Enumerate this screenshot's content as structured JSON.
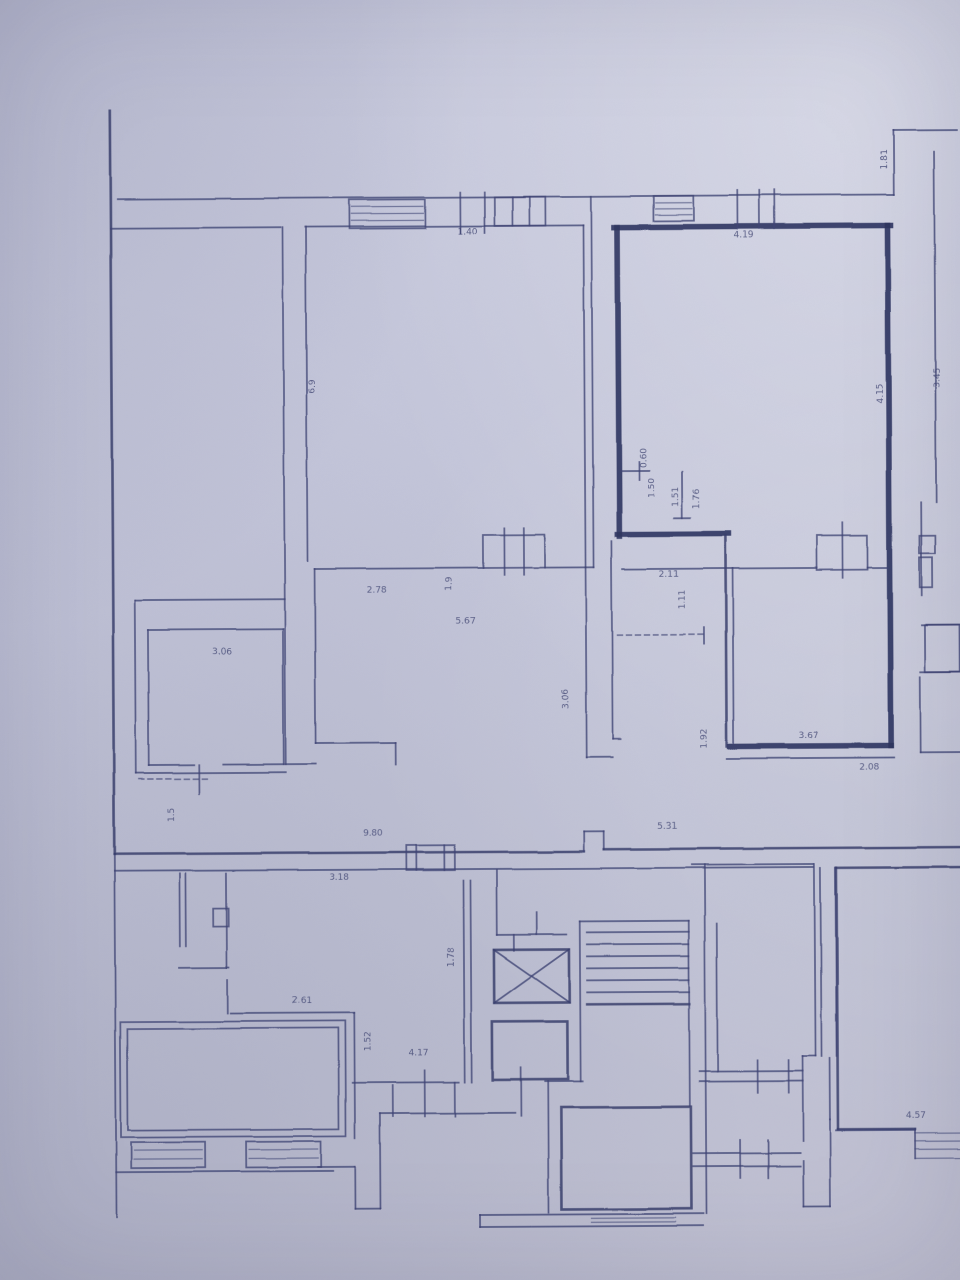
{
  "document": {
    "kind": "scanned architectural floor plan photo",
    "paper_color": "#c4c6da",
    "ink_color": "#3e4374",
    "thick_wall_color": "#2f355f"
  },
  "plan": {
    "walls": [
      [
        113,
        108,
        113,
        852,
        "m"
      ],
      [
        113,
        852,
        113,
        1215,
        "t"
      ],
      [
        120,
        197,
        897,
        197,
        "t"
      ],
      [
        897,
        133,
        897,
        197,
        "t"
      ],
      [
        897,
        133,
        960,
        133,
        "t"
      ],
      [
        937,
        155,
        937,
        505,
        "t"
      ],
      [
        922,
        505,
        922,
        598,
        "t"
      ],
      [
        113,
        226,
        283,
        226,
        "t"
      ],
      [
        285,
        226,
        285,
        763,
        "t"
      ],
      [
        308,
        226,
        308,
        560,
        "t"
      ],
      [
        308,
        226,
        586,
        226,
        "t"
      ],
      [
        594,
        197,
        594,
        568,
        "t"
      ],
      [
        586,
        226,
        586,
        568,
        "t"
      ],
      [
        586,
        568,
        586,
        758,
        "t"
      ],
      [
        612,
        542,
        612,
        740,
        "t"
      ],
      [
        586,
        758,
        612,
        758,
        "t"
      ],
      [
        612,
        740,
        620,
        740,
        "t"
      ],
      [
        315,
        568,
        484,
        568,
        "t"
      ],
      [
        545,
        568,
        594,
        568,
        "t"
      ],
      [
        315,
        568,
        315,
        742,
        "t"
      ],
      [
        315,
        742,
        395,
        742,
        "t"
      ],
      [
        395,
        742,
        395,
        764,
        "t"
      ],
      [
        135,
        598,
        285,
        598,
        "t"
      ],
      [
        135,
        598,
        135,
        771,
        "t"
      ],
      [
        135,
        771,
        285,
        771,
        "t"
      ],
      [
        148,
        628,
        283,
        628,
        "t"
      ],
      [
        148,
        628,
        148,
        763,
        "t"
      ],
      [
        283,
        628,
        283,
        763,
        "t"
      ],
      [
        148,
        763,
        193,
        763,
        "t"
      ],
      [
        222,
        763,
        283,
        763,
        "t"
      ],
      [
        198,
        763,
        198,
        792,
        "t"
      ],
      [
        285,
        763,
        315,
        763,
        "t"
      ],
      [
        617,
        228,
        893,
        228,
        "k"
      ],
      [
        620,
        228,
        620,
        537,
        "k"
      ],
      [
        890,
        228,
        890,
        748,
        "k"
      ],
      [
        729,
        748,
        890,
        748,
        "k"
      ],
      [
        618,
        535,
        729,
        535,
        "k"
      ],
      [
        726,
        537,
        726,
        748,
        "m"
      ],
      [
        733,
        570,
        733,
        745,
        "t"
      ],
      [
        623,
        570,
        817,
        570,
        "t"
      ],
      [
        868,
        570,
        888,
        570,
        "t"
      ],
      [
        726,
        760,
        893,
        760,
        "t"
      ],
      [
        617,
        636,
        704,
        636,
        "d"
      ],
      [
        704,
        629,
        704,
        645,
        "t"
      ],
      [
        622,
        472,
        650,
        472,
        "t"
      ],
      [
        640,
        463,
        640,
        481,
        "t"
      ],
      [
        683,
        473,
        683,
        519,
        "t"
      ],
      [
        675,
        519,
        691,
        519,
        "t"
      ],
      [
        113,
        852,
        583,
        852,
        "m"
      ],
      [
        583,
        832,
        583,
        852,
        "t"
      ],
      [
        583,
        832,
        603,
        832,
        "t"
      ],
      [
        603,
        832,
        603,
        850,
        "t"
      ],
      [
        603,
        850,
        960,
        850,
        "m"
      ],
      [
        113,
        869,
        812,
        869,
        "t"
      ],
      [
        835,
        870,
        960,
        870,
        "m"
      ],
      [
        835,
        870,
        835,
        1132,
        "m"
      ],
      [
        835,
        1132,
        912,
        1132,
        "m"
      ],
      [
        178,
        872,
        178,
        944,
        "t"
      ],
      [
        184,
        872,
        184,
        944,
        "t"
      ],
      [
        225,
        872,
        225,
        966,
        "t"
      ],
      [
        177,
        966,
        227,
        966,
        "t"
      ],
      [
        225,
        978,
        225,
        1012,
        "t"
      ],
      [
        228,
        1012,
        352,
        1012,
        "t"
      ],
      [
        352,
        1012,
        352,
        1137,
        "t"
      ],
      [
        113,
        1170,
        330,
        1170,
        "t"
      ],
      [
        315,
        1166,
        352,
        1166,
        "t"
      ],
      [
        352,
        1166,
        352,
        1208,
        "t"
      ],
      [
        352,
        1208,
        377,
        1208,
        "t"
      ],
      [
        377,
        1113,
        377,
        1208,
        "t"
      ],
      [
        377,
        1113,
        512,
        1113,
        "t"
      ],
      [
        390,
        1085,
        390,
        1116,
        "t"
      ],
      [
        422,
        1070,
        422,
        1116,
        "t"
      ],
      [
        452,
        1082,
        452,
        1116,
        "t"
      ],
      [
        518,
        1068,
        518,
        1116,
        "t"
      ],
      [
        350,
        1082,
        456,
        1082,
        "t"
      ],
      [
        462,
        880,
        462,
        1082,
        "t"
      ],
      [
        469,
        880,
        469,
        1082,
        "t"
      ],
      [
        495,
        870,
        495,
        935,
        "t"
      ],
      [
        495,
        935,
        565,
        935,
        "t"
      ],
      [
        512,
        935,
        512,
        951,
        "t"
      ],
      [
        535,
        913,
        535,
        935,
        "t"
      ],
      [
        492,
        950,
        567,
        1003,
        "t"
      ],
      [
        567,
        950,
        492,
        1003,
        "t"
      ],
      [
        542,
        1082,
        580,
        1082,
        "t"
      ],
      [
        578,
        922,
        578,
        1082,
        "t"
      ],
      [
        578,
        922,
        687,
        922,
        "t"
      ],
      [
        585,
        933,
        687,
        933,
        "t"
      ],
      [
        585,
        945,
        687,
        945,
        "t"
      ],
      [
        585,
        957,
        687,
        957,
        "t"
      ],
      [
        585,
        969,
        687,
        969,
        "t"
      ],
      [
        585,
        981,
        687,
        981,
        "t"
      ],
      [
        585,
        993,
        687,
        993,
        "t"
      ],
      [
        585,
        1005,
        687,
        1005,
        "m"
      ],
      [
        687,
        922,
        687,
        1107,
        "t"
      ],
      [
        703,
        866,
        703,
        1215,
        "t"
      ],
      [
        715,
        925,
        715,
        1073,
        "t"
      ],
      [
        545,
        1082,
        545,
        1213,
        "t"
      ],
      [
        477,
        1215,
        700,
        1215,
        "t"
      ],
      [
        477,
        1227,
        700,
        1227,
        "t"
      ],
      [
        477,
        1215,
        477,
        1227,
        "t"
      ],
      [
        690,
        866,
        812,
        866,
        "t"
      ],
      [
        813,
        866,
        813,
        1058,
        "t"
      ],
      [
        819,
        870,
        819,
        1058,
        "t"
      ],
      [
        834,
        870,
        834,
        1058,
        "t"
      ],
      [
        800,
        1058,
        813,
        1058,
        "t"
      ],
      [
        800,
        1058,
        800,
        1143,
        "t"
      ],
      [
        697,
        1073,
        800,
        1073,
        "t"
      ],
      [
        697,
        1083,
        800,
        1083,
        "t"
      ],
      [
        755,
        1062,
        755,
        1095,
        "t"
      ],
      [
        786,
        1062,
        786,
        1095,
        "t"
      ],
      [
        690,
        1155,
        797,
        1155,
        "t"
      ],
      [
        690,
        1168,
        797,
        1168,
        "t"
      ],
      [
        737,
        1142,
        737,
        1180,
        "t"
      ],
      [
        765,
        1142,
        765,
        1180,
        "t"
      ],
      [
        800,
        1163,
        800,
        1208,
        "t"
      ],
      [
        827,
        1122,
        827,
        1208,
        "t"
      ],
      [
        800,
        1208,
        827,
        1208,
        "t"
      ],
      [
        833,
        1133,
        912,
        1133,
        "t"
      ],
      [
        827,
        1060,
        827,
        1122,
        "t"
      ],
      [
        922,
        628,
        960,
        628,
        "t"
      ],
      [
        920,
        675,
        960,
        675,
        "t"
      ],
      [
        920,
        680,
        920,
        755,
        "t"
      ],
      [
        920,
        755,
        960,
        755,
        "t"
      ],
      [
        463,
        192,
        463,
        233,
        "t"
      ],
      [
        487,
        192,
        487,
        233,
        "t"
      ],
      [
        515,
        197,
        515,
        226,
        "t"
      ],
      [
        532,
        197,
        532,
        226,
        "t"
      ],
      [
        740,
        192,
        740,
        230,
        "t"
      ],
      [
        762,
        192,
        762,
        230,
        "t"
      ],
      [
        777,
        192,
        777,
        230,
        "t"
      ],
      [
        415,
        845,
        415,
        870,
        "t"
      ],
      [
        443,
        845,
        443,
        870,
        "t"
      ],
      [
        505,
        528,
        505,
        575,
        "t"
      ],
      [
        524,
        528,
        524,
        575,
        "t"
      ],
      [
        843,
        525,
        843,
        580,
        "t"
      ],
      [
        138,
        777,
        208,
        777,
        "d"
      ],
      [
        912,
        1132,
        912,
        1161,
        "t"
      ]
    ],
    "boxes": [
      [
        352,
        199,
        76,
        29,
        "t"
      ],
      [
        497,
        197,
        51,
        29,
        "t"
      ],
      [
        656,
        197,
        40,
        25,
        "t"
      ],
      [
        405,
        845,
        48,
        25,
        "t"
      ],
      [
        484,
        535,
        61,
        33,
        "t"
      ],
      [
        817,
        538,
        51,
        34,
        "t"
      ],
      [
        492,
        950,
        75,
        53,
        "m"
      ],
      [
        490,
        1022,
        75,
        58,
        "m"
      ],
      [
        212,
        907,
        15,
        18,
        "t"
      ],
      [
        920,
        538,
        16,
        18,
        "t"
      ],
      [
        920,
        560,
        13,
        30,
        "t"
      ],
      [
        925,
        628,
        35,
        47,
        "t"
      ],
      [
        118,
        1020,
        225,
        115,
        "t"
      ],
      [
        125,
        1027,
        211,
        101,
        "t"
      ],
      [
        128,
        1140,
        74,
        26,
        "t"
      ],
      [
        243,
        1140,
        75,
        26,
        "t"
      ],
      [
        558,
        1108,
        130,
        102,
        "m"
      ]
    ],
    "hatches": [
      [
        354,
        426,
        [
          206,
          213,
          220
        ]
      ],
      [
        658,
        694,
        [
          204,
          210,
          216
        ]
      ],
      [
        131,
        199,
        [
          1148,
          1157
        ]
      ],
      [
        246,
        315,
        [
          1148,
          1157
        ]
      ],
      [
        588,
        672,
        [
          1219,
          1223
        ]
      ],
      [
        912,
        960,
        [
          1136,
          1144,
          1152,
          1161
        ]
      ]
    ],
    "labels": [
      [
        "6.9",
        316,
        386,
        -90
      ],
      [
        "1.40",
        470,
        234,
        0
      ],
      [
        "4.19",
        746,
        239,
        0
      ],
      [
        "1.81",
        890,
        162,
        -90
      ],
      [
        "3.45",
        941,
        380,
        -90
      ],
      [
        "4.15",
        884,
        396,
        -90
      ],
      [
        "0.60",
        647,
        459,
        -90
      ],
      [
        "1.50",
        655,
        489,
        -90
      ],
      [
        "1.51",
        679,
        498,
        -90
      ],
      [
        "1.76",
        700,
        500,
        -90
      ],
      [
        "2.78",
        377,
        592,
        0
      ],
      [
        "1.9",
        452,
        584,
        -90
      ],
      [
        "5.67",
        466,
        624,
        0
      ],
      [
        "3.06",
        568,
        699,
        -90
      ],
      [
        "2.11",
        669,
        578,
        0
      ],
      [
        "1.11",
        685,
        601,
        -90
      ],
      [
        "3.06",
        222,
        653,
        0
      ],
      [
        "1.5",
        173,
        813,
        -90
      ],
      [
        "9.80",
        372,
        835,
        0
      ],
      [
        "5.31",
        666,
        830,
        0
      ],
      [
        "1.92",
        706,
        740,
        -90
      ],
      [
        "3.67",
        808,
        740,
        0
      ],
      [
        "2.08",
        868,
        772,
        0
      ],
      [
        "3.18",
        338,
        879,
        0
      ],
      [
        "2.61",
        300,
        1002,
        0
      ],
      [
        "1.78",
        452,
        957,
        -90
      ],
      [
        "1.52",
        368,
        1041,
        -90
      ],
      [
        "4.17",
        416,
        1055,
        0
      ],
      [
        "4.57",
        913,
        1121,
        0
      ]
    ]
  }
}
